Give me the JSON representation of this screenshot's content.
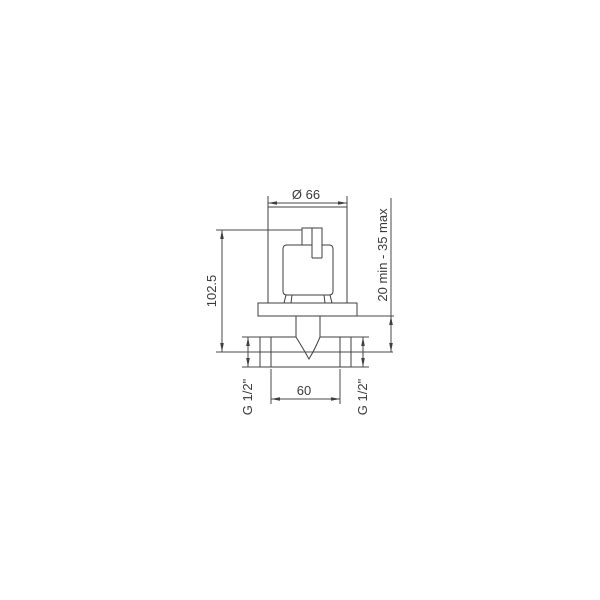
{
  "colors": {
    "background": "#ffffff",
    "line": "#3f3f3f",
    "text": "#3a3a3a"
  },
  "dimensions": {
    "plate_diameter": "Ø 66",
    "total_height": "102.5",
    "install_depth": "20 min - 35 max",
    "thread_left": "G 1/2\"",
    "thread_right": "G 1/2\"",
    "port_spacing": "60"
  }
}
